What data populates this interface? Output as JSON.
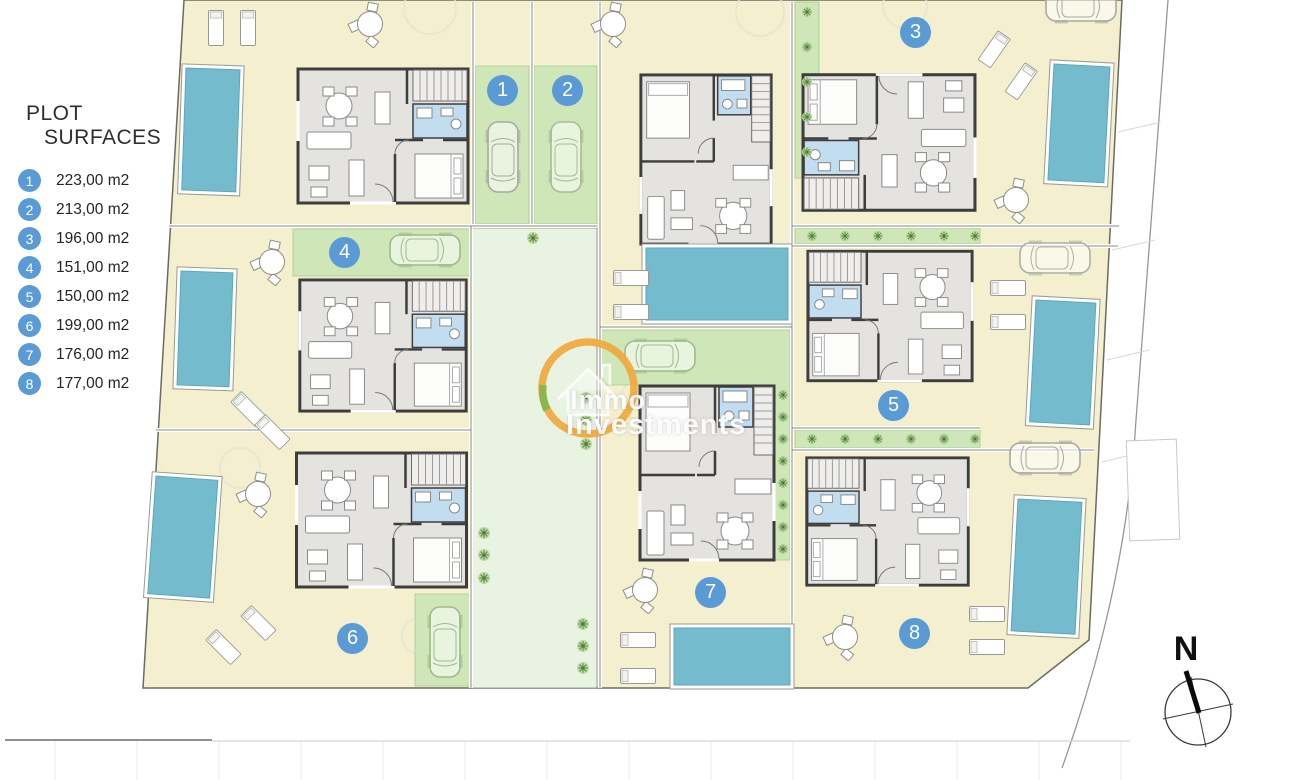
{
  "legend": {
    "title_line1": "PLOT",
    "title_line2": "SURFACES",
    "items": [
      {
        "num": "1",
        "area": "223,00 m2"
      },
      {
        "num": "2",
        "area": "213,00 m2"
      },
      {
        "num": "3",
        "area": "196,00 m2"
      },
      {
        "num": "4",
        "area": "151,00 m2"
      },
      {
        "num": "5",
        "area": "150,00 m2"
      },
      {
        "num": "6",
        "area": "199,00 m2"
      },
      {
        "num": "7",
        "area": "176,00 m2"
      },
      {
        "num": "8",
        "area": "177,00 m2"
      }
    ]
  },
  "plan_markers": [
    {
      "num": "1"
    },
    {
      "num": "2"
    },
    {
      "num": "3"
    },
    {
      "num": "4"
    },
    {
      "num": "5"
    },
    {
      "num": "6"
    },
    {
      "num": "7"
    },
    {
      "num": "8"
    }
  ],
  "watermark": {
    "line1": "Immo",
    "line2": "Investments"
  },
  "compass": {
    "north_label": "N"
  },
  "colors": {
    "marker_blue": "#5b9bd5",
    "pool_blue": "#74bccd",
    "yard_cream": "#f4efcf",
    "parking_green": "#cfe6b8",
    "communal_green": "#e9f3e2",
    "logo_orange": "#f1a93d"
  }
}
